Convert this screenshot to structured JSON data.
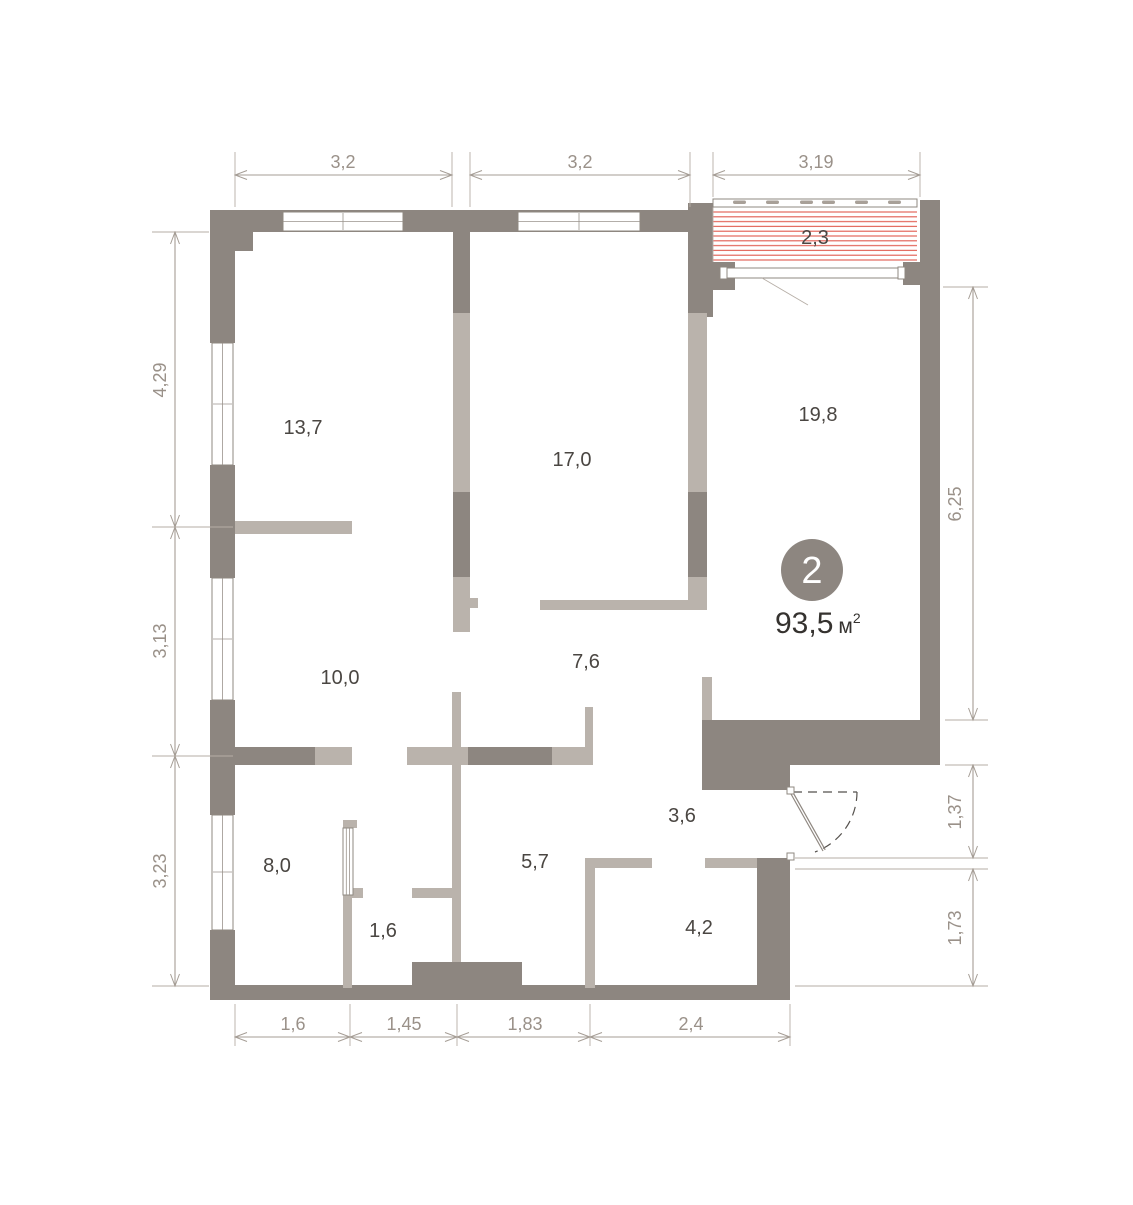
{
  "plan": {
    "badge": {
      "rooms_count": "2",
      "area_value": "93,5",
      "area_unit": "м",
      "area_sup": "2"
    },
    "rooms": [
      {
        "area": "13,7"
      },
      {
        "area": "17,0"
      },
      {
        "area": "19,8"
      },
      {
        "area": "10,0"
      },
      {
        "area": "7,6"
      },
      {
        "area": "8,0"
      },
      {
        "area": "1,6"
      },
      {
        "area": "5,7"
      },
      {
        "area": "3,6"
      },
      {
        "area": "4,2"
      }
    ],
    "balcony": {
      "area": "2,3"
    },
    "dimensions": {
      "top": [
        "3,2",
        "3,2",
        "3,19"
      ],
      "left": [
        "4,29",
        "3,13",
        "3,23"
      ],
      "right": [
        "6,25",
        "1,37",
        "1,73"
      ],
      "bottom": [
        "1,6",
        "1,45",
        "1,83",
        "2,4"
      ]
    },
    "colors": {
      "wall_dark": "#8d8680",
      "wall_light": "#bab3ac",
      "hatch_red": "#e0594d",
      "dimension_gray": "#a59d95",
      "room_text": "#4a4642"
    }
  }
}
